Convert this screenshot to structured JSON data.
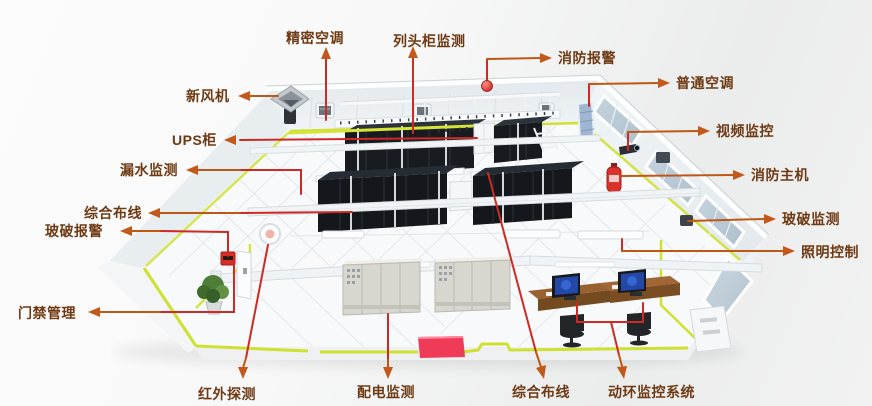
{
  "diagram": {
    "type": "annotated-isometric-illustration",
    "subject": "server-machine-room-monitoring-systems"
  },
  "labels": [
    {
      "id": "precision-ac",
      "text": "精密空调"
    },
    {
      "id": "row-head-cabinet-monitoring",
      "text": "列头柜监测"
    },
    {
      "id": "fire-alarm",
      "text": "消防报警"
    },
    {
      "id": "fresh-air-fan",
      "text": "新风机"
    },
    {
      "id": "regular-ac",
      "text": "普通空调"
    },
    {
      "id": "ups-cabinet",
      "text": "UPS柜"
    },
    {
      "id": "video-surveillance",
      "text": "视频监控"
    },
    {
      "id": "water-leak-monitoring",
      "text": "漏水监测"
    },
    {
      "id": "fire-control-host",
      "text": "消防主机"
    },
    {
      "id": "integrated-cabling-left",
      "text": "综合布线"
    },
    {
      "id": "glass-break-monitoring",
      "text": "玻破监测"
    },
    {
      "id": "glass-break-alarm",
      "text": "玻破报警"
    },
    {
      "id": "lighting-control",
      "text": "照明控制"
    },
    {
      "id": "access-control",
      "text": "门禁管理"
    },
    {
      "id": "infrared-detection",
      "text": "红外探测"
    },
    {
      "id": "power-distribution-monitoring",
      "text": "配电监测"
    },
    {
      "id": "integrated-cabling-bottom",
      "text": "综合布线"
    },
    {
      "id": "facility-monitoring-system",
      "text": "动环监控系统"
    }
  ],
  "palette": {
    "label_text": "#6e3a14",
    "connector_red": "#ce2a25",
    "connector_orange": "#bf5716",
    "floor_stripe_yellow": "#cfe030",
    "rack_black": "#14181d",
    "carpet_red": "#f03b58",
    "desk_brown": "#9a6130",
    "screen_blue": "#2448a8",
    "wall_gray": "#e9eef1",
    "window_glass": "#b9c9d6",
    "alarm_device_red": "#d62f28"
  }
}
